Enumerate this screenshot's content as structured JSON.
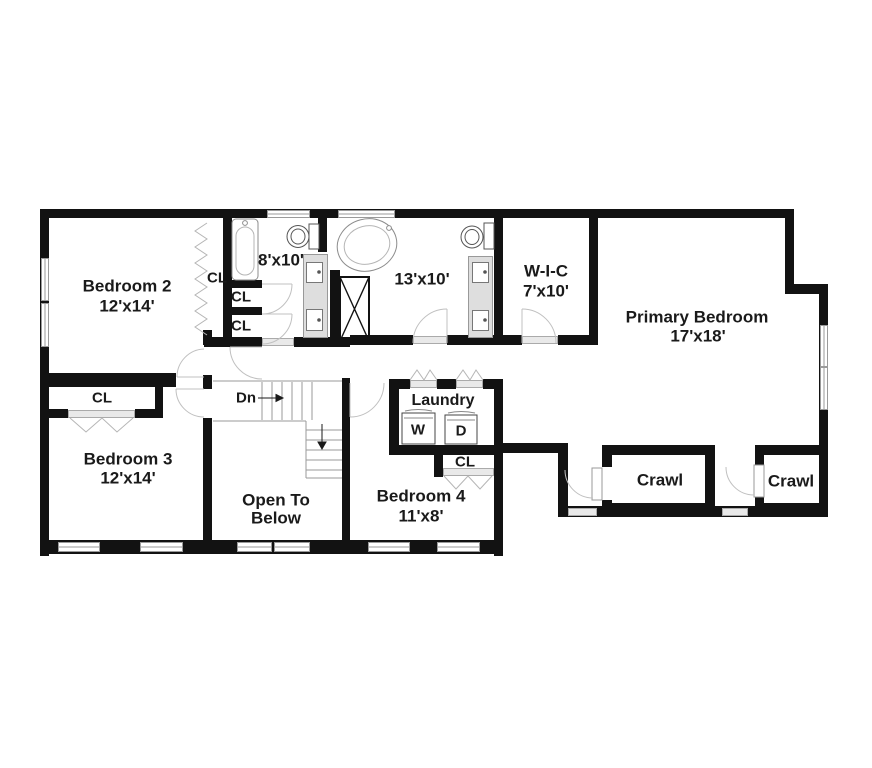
{
  "rooms": {
    "bedroom2": {
      "name": "Bedroom 2",
      "dims": "12'x14'"
    },
    "bedroom3": {
      "name": "Bedroom 3",
      "dims": "12'x14'"
    },
    "bedroom4": {
      "name": "Bedroom 4",
      "dims": "11'x8'"
    },
    "primary_bedroom": {
      "name": "Primary Bedroom",
      "dims": "17'x18'"
    },
    "walk_in_closet": {
      "name": "W-I-C",
      "dims": "7'x10'"
    },
    "hall_bathroom": {
      "dims": "8'x10'"
    },
    "primary_bathroom": {
      "dims": "13'x10'"
    },
    "laundry": {
      "name": "Laundry",
      "washer": "W",
      "dryer": "D"
    },
    "open_to_below": {
      "line1": "Open To",
      "line2": "Below"
    },
    "crawl_left": {
      "name": "Crawl"
    },
    "crawl_right": {
      "name": "Crawl"
    }
  },
  "annotations": {
    "closet_abbrev": "CL",
    "stairs_down": "Dn"
  },
  "colors": {
    "wall": "#121212",
    "fixture_fill": "#dedede",
    "fixture_border": "#999999",
    "thin_line": "#c0c0c0",
    "text": "#1a1a1a",
    "background": "#ffffff"
  }
}
